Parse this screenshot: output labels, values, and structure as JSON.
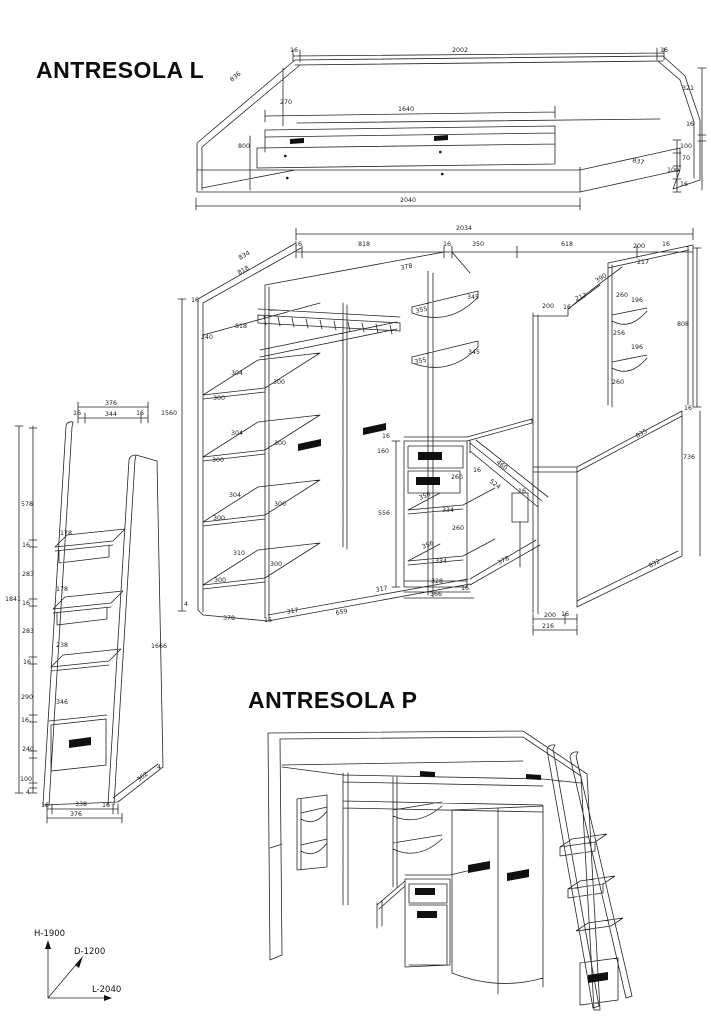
{
  "titles": {
    "antresola_l": "ANTRESOLA L",
    "antresola_p": "ANTRESOLA P"
  },
  "axis_legend": {
    "h": "H-1900",
    "d": "D-1200",
    "l": "L-2040"
  },
  "bed_frame": {
    "labels": [
      "16",
      "2002",
      "16",
      "836",
      "270",
      "1640",
      "800",
      "321",
      "16",
      "100",
      "70",
      "100",
      "16",
      "837",
      "2040"
    ]
  },
  "main_unit": {
    "labels": [
      "2034",
      "16",
      "818",
      "16",
      "350",
      "618",
      "200",
      "16",
      "834",
      "818",
      "16",
      "818",
      "240",
      "304",
      "300",
      "300",
      "304",
      "300",
      "300",
      "304",
      "300",
      "300",
      "310",
      "300",
      "300",
      "1560",
      "4",
      "378",
      "16",
      "317",
      "659",
      "317",
      "378",
      "355",
      "355",
      "345",
      "345",
      "16",
      "160",
      "260",
      "356",
      "334",
      "556",
      "260",
      "356",
      "334",
      "328",
      "16",
      "366",
      "16",
      "460",
      "524",
      "16",
      "217",
      "390",
      "260",
      "196",
      "200",
      "16",
      "217",
      "256",
      "196",
      "260",
      "808",
      "16",
      "835",
      "736",
      "832",
      "200",
      "16",
      "216",
      "378"
    ]
  },
  "ladder": {
    "labels": [
      "376",
      "16",
      "344",
      "16",
      "578",
      "178",
      "16",
      "283",
      "1841",
      "178",
      "16",
      "283",
      "238",
      "16",
      "290",
      "346",
      "16",
      "240",
      "100",
      "4",
      "16",
      "338",
      "16",
      "376",
      "362",
      "4",
      "1666"
    ]
  }
}
